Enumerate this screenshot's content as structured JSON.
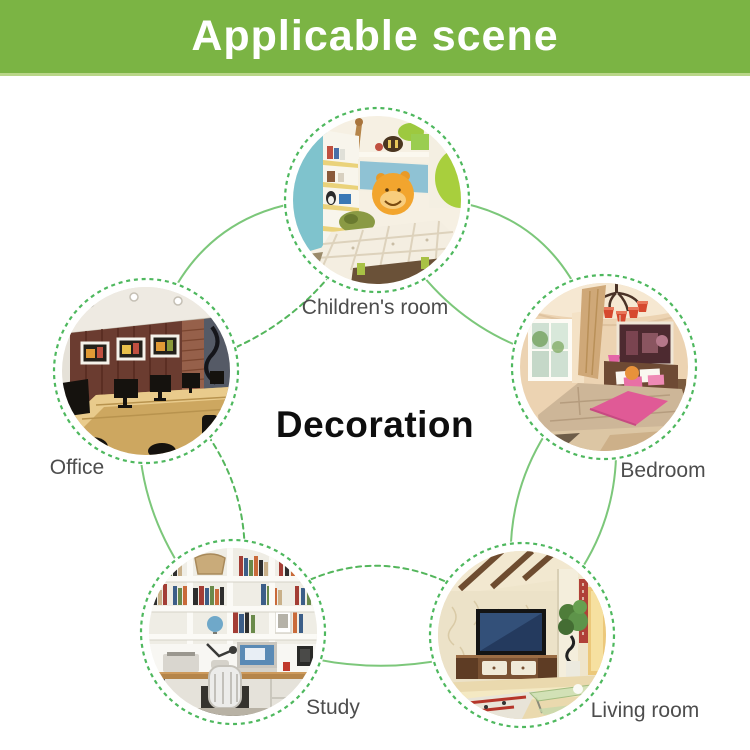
{
  "header": {
    "title": "Applicable scene",
    "bg_color": "#7bb444",
    "accent_edge_color": "#b9d688",
    "text_color": "#ffffff"
  },
  "center": {
    "label": "Decoration"
  },
  "scenes": [
    {
      "id": "childrens-room",
      "label": "Children's room",
      "position": "top"
    },
    {
      "id": "office",
      "label": "Office",
      "position": "left"
    },
    {
      "id": "bedroom",
      "label": "Bedroom",
      "position": "right"
    },
    {
      "id": "study",
      "label": "Study",
      "position": "bottom-left"
    },
    {
      "id": "living-room",
      "label": "Living room",
      "position": "bottom-right"
    }
  ],
  "colors": {
    "connector_solid_green": "#7cc77a",
    "connector_dashed_green": "#54b65c",
    "label_gray": "#4d4d4d"
  }
}
